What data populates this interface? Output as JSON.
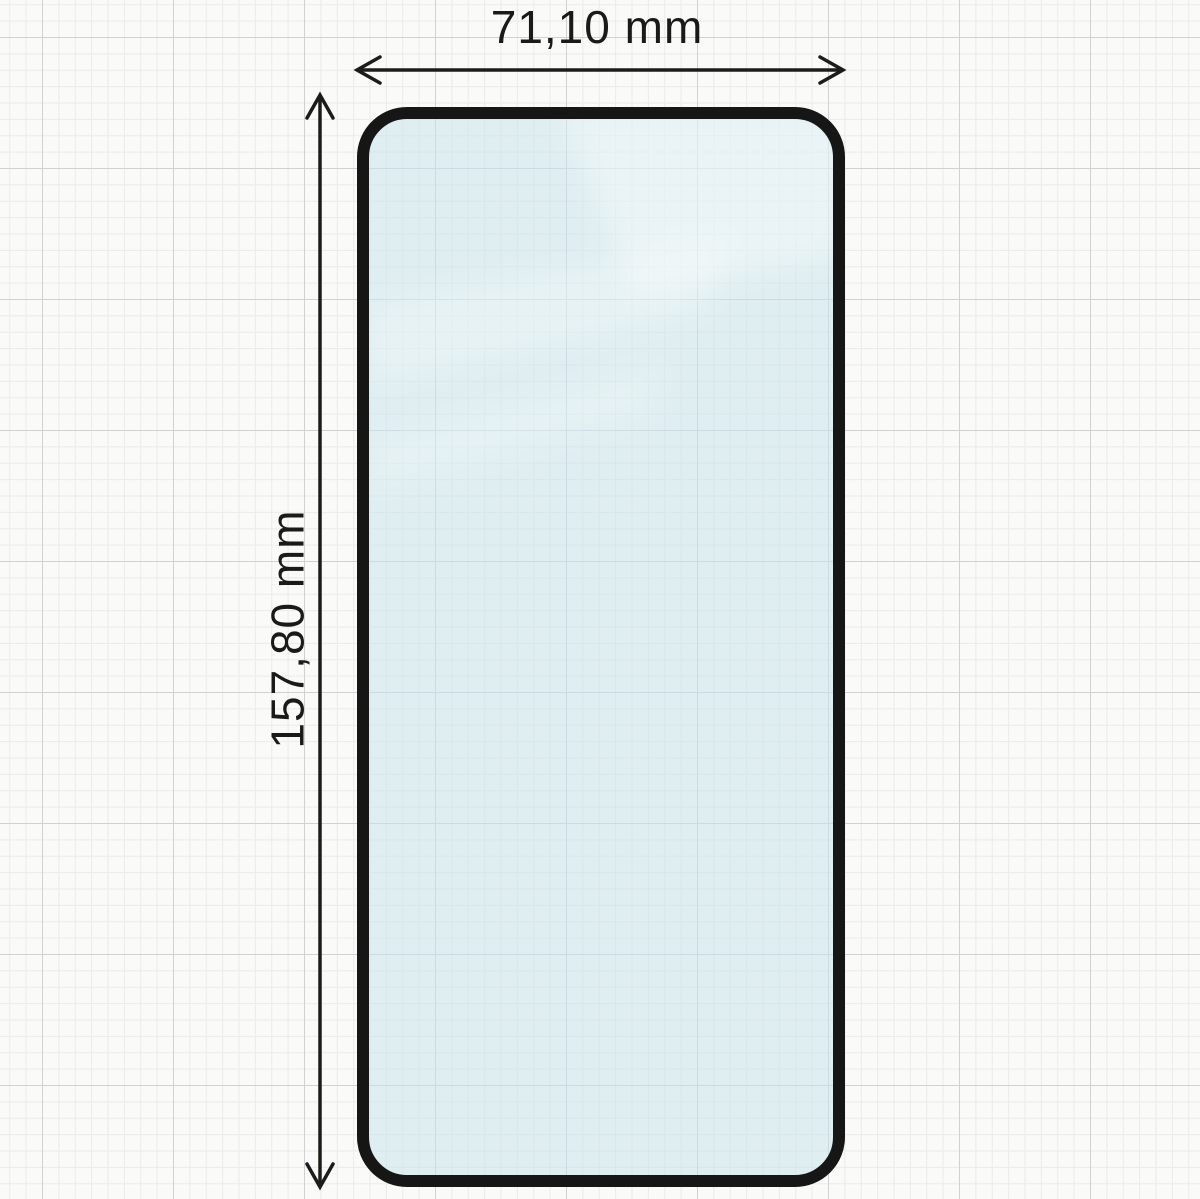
{
  "diagram": {
    "width_label": "71,10 mm",
    "height_label": "157,80 mm",
    "colors": {
      "paper_background": "#fafaf9",
      "grid_minor": "#ebebe9",
      "grid_major": "#cfd1d3",
      "glass_fill": "rgba(201,228,235,0.55)",
      "glass_outline": "#161616",
      "arrow": "#1c1c1c",
      "text": "#1a1a1a",
      "reflection": "#ffffff"
    }
  }
}
